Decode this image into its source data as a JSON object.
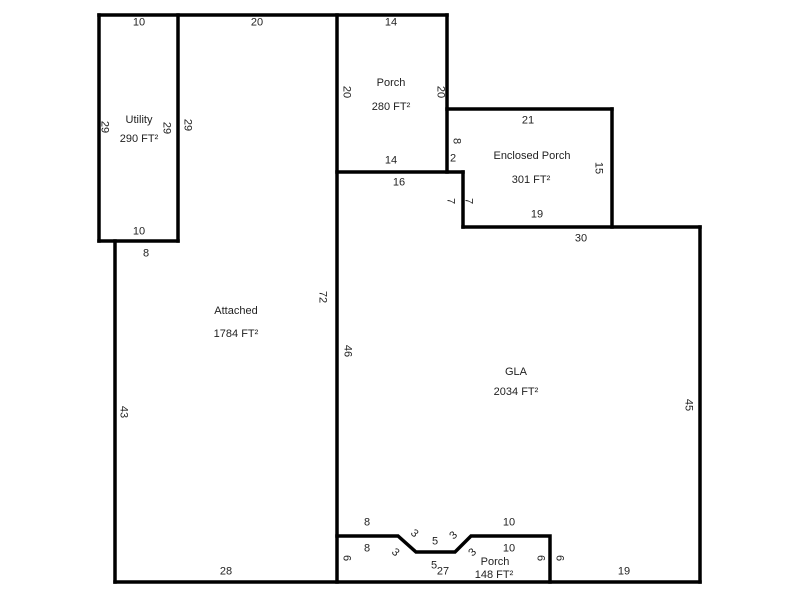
{
  "canvas": {
    "width": 800,
    "height": 600,
    "background": "#ffffff"
  },
  "sketch": {
    "wall_color": "#000000",
    "text_color": "#1f1f1f",
    "regions": [
      {
        "name": "Utility",
        "area": "290 FT²",
        "name_x": 139,
        "name_y": 120,
        "area_x": 139,
        "area_y": 139
      },
      {
        "name": "Porch",
        "area": "280 FT²",
        "name_x": 391,
        "name_y": 83,
        "area_x": 391,
        "area_y": 107
      },
      {
        "name": "Enclosed Porch",
        "area": "301 FT²",
        "name_x": 532,
        "name_y": 156,
        "area_x": 531,
        "area_y": 180
      },
      {
        "name": "Attached",
        "area": "1784 FT²",
        "name_x": 236,
        "name_y": 311,
        "area_x": 236,
        "area_y": 334
      },
      {
        "name": "GLA",
        "area": "2034 FT²",
        "name_x": 516,
        "name_y": 372,
        "area_x": 516,
        "area_y": 392
      },
      {
        "name": "Porch",
        "area": "148 FT²",
        "name_x": 495,
        "name_y": 562,
        "area_x": 494,
        "area_y": 575
      }
    ],
    "dimension_labels": [
      {
        "text": "10",
        "x": 139,
        "y": 23,
        "rot": 0
      },
      {
        "text": "20",
        "x": 257,
        "y": 23,
        "rot": 0
      },
      {
        "text": "14",
        "x": 391,
        "y": 23,
        "rot": 0
      },
      {
        "text": "29",
        "x": 104,
        "y": 127,
        "rot": 90
      },
      {
        "text": "29",
        "x": 166,
        "y": 128,
        "rot": 90
      },
      {
        "text": "29",
        "x": 187,
        "y": 125,
        "rot": 90
      },
      {
        "text": "20",
        "x": 346,
        "y": 92,
        "rot": 90
      },
      {
        "text": "20",
        "x": 440,
        "y": 92,
        "rot": 90
      },
      {
        "text": "21",
        "x": 528,
        "y": 121,
        "rot": 0
      },
      {
        "text": "8",
        "x": 456,
        "y": 141,
        "rot": 90
      },
      {
        "text": "2",
        "x": 453,
        "y": 159,
        "rot": 0
      },
      {
        "text": "15",
        "x": 598,
        "y": 168,
        "rot": 90
      },
      {
        "text": "14",
        "x": 391,
        "y": 161,
        "rot": 0
      },
      {
        "text": "16",
        "x": 399,
        "y": 183,
        "rot": 0
      },
      {
        "text": "7",
        "x": 450,
        "y": 201,
        "rot": 90
      },
      {
        "text": "7",
        "x": 468,
        "y": 201,
        "rot": 90
      },
      {
        "text": "19",
        "x": 537,
        "y": 215,
        "rot": 0
      },
      {
        "text": "30",
        "x": 581,
        "y": 239,
        "rot": 0
      },
      {
        "text": "10",
        "x": 139,
        "y": 232,
        "rot": 0
      },
      {
        "text": "8",
        "x": 146,
        "y": 254,
        "rot": 0
      },
      {
        "text": "72",
        "x": 322,
        "y": 297,
        "rot": 90
      },
      {
        "text": "46",
        "x": 347,
        "y": 351,
        "rot": 90
      },
      {
        "text": "43",
        "x": 123,
        "y": 412,
        "rot": 90
      },
      {
        "text": "45",
        "x": 688,
        "y": 405,
        "rot": 90
      },
      {
        "text": "8",
        "x": 367,
        "y": 523,
        "rot": 0
      },
      {
        "text": "3",
        "x": 414,
        "y": 534,
        "rot": 42
      },
      {
        "text": "5",
        "x": 435,
        "y": 542,
        "rot": 0
      },
      {
        "text": "3",
        "x": 454,
        "y": 536,
        "rot": -45
      },
      {
        "text": "10",
        "x": 509,
        "y": 523,
        "rot": 0
      },
      {
        "text": "8",
        "x": 367,
        "y": 549,
        "rot": 0
      },
      {
        "text": "3",
        "x": 395,
        "y": 553,
        "rot": 42
      },
      {
        "text": "5",
        "x": 434,
        "y": 566,
        "rot": 0
      },
      {
        "text": "3",
        "x": 473,
        "y": 553,
        "rot": -45
      },
      {
        "text": "10",
        "x": 509,
        "y": 549,
        "rot": 0
      },
      {
        "text": "6",
        "x": 346,
        "y": 558,
        "rot": 90
      },
      {
        "text": "6",
        "x": 540,
        "y": 558,
        "rot": 90
      },
      {
        "text": "6",
        "x": 559,
        "y": 558,
        "rot": 90
      },
      {
        "text": "28",
        "x": 226,
        "y": 572,
        "rot": 0
      },
      {
        "text": "27",
        "x": 443,
        "y": 572,
        "rot": 0
      },
      {
        "text": "19",
        "x": 624,
        "y": 572,
        "rot": 0
      }
    ]
  }
}
